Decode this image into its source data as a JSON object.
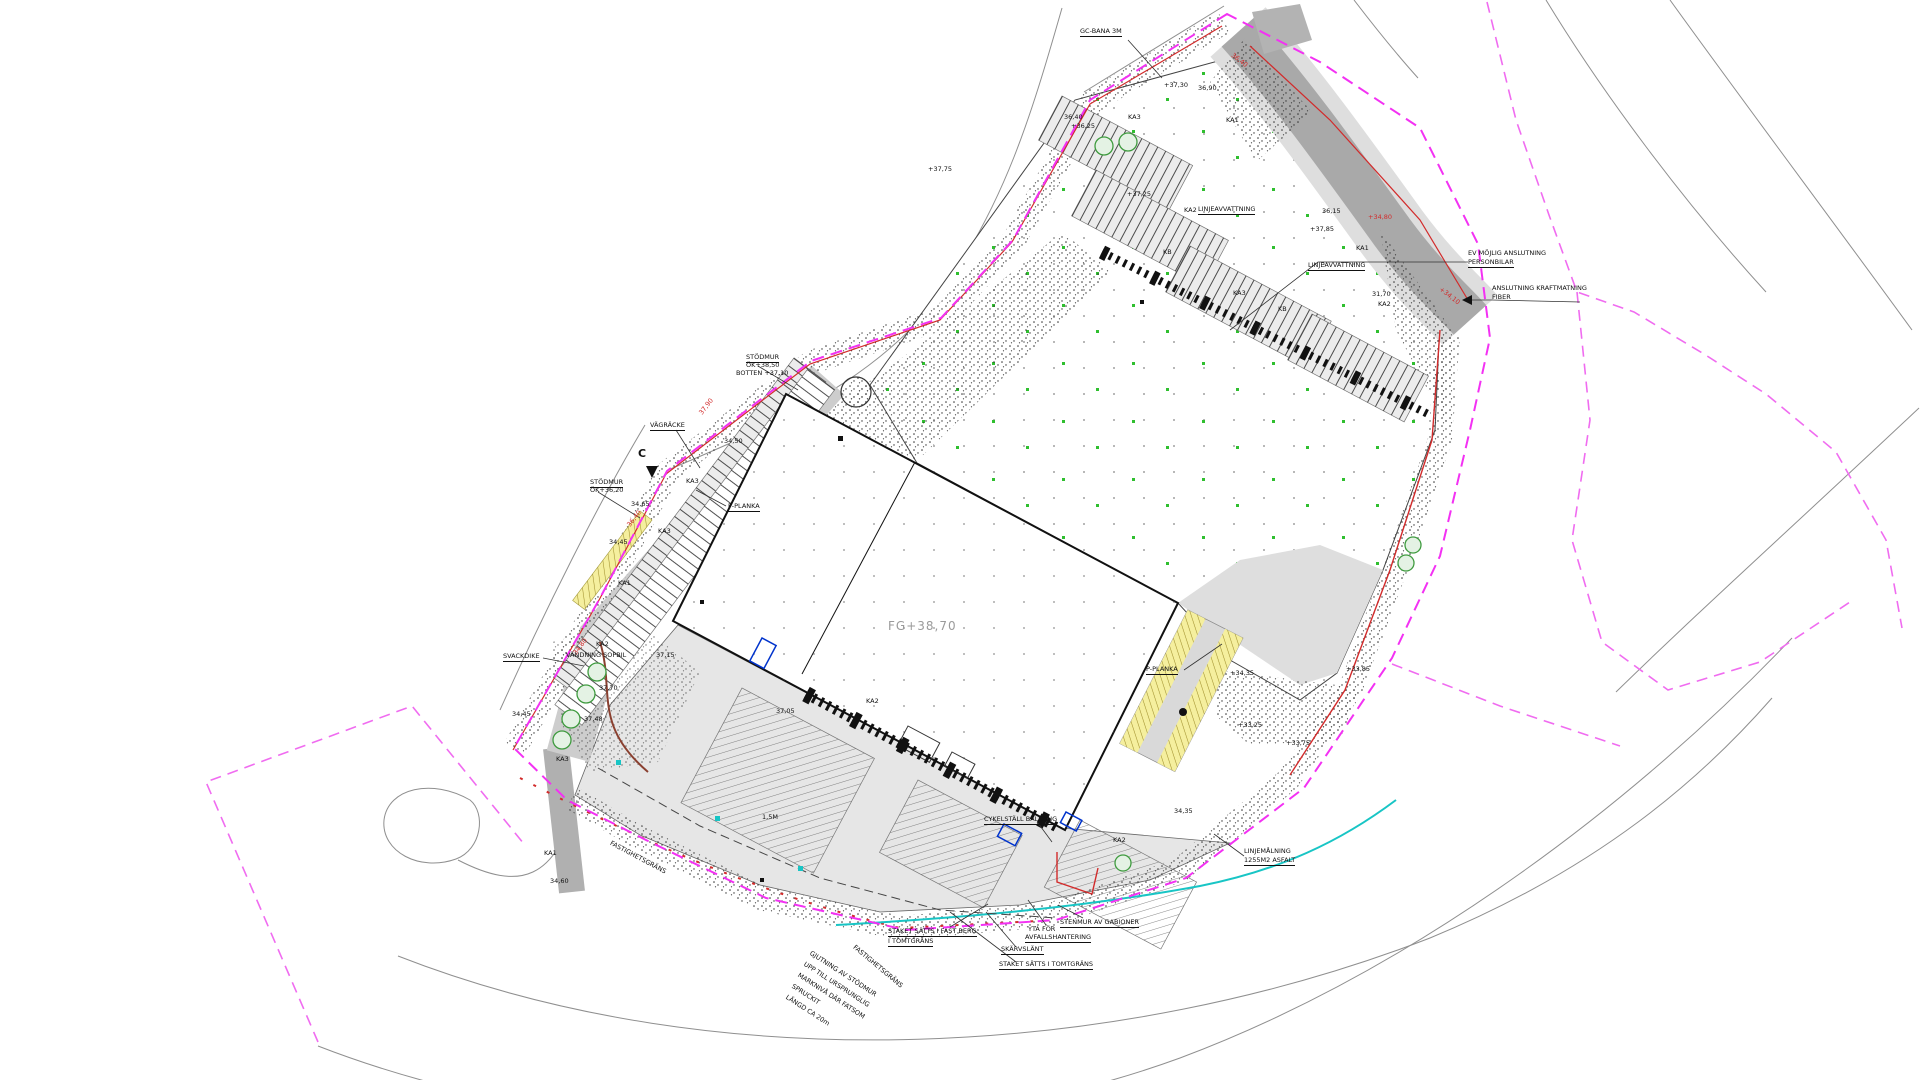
{
  "colors": {
    "property_boundary_magenta": "#f331f3",
    "outer_parcel_magenta": "#f06cf0",
    "curb_red": "#d22b2b",
    "water_line_cyan": "#18c5c5",
    "tree_green": "#3f9b3f",
    "speck_green": "#2fbf2f",
    "road_dark_gray": "#a9a9a9",
    "pavement_gray": "#e6e6e6",
    "marking_yellow": "#f5ef9e",
    "door_blue": "#0033cc",
    "slope_brown": "#8a4030"
  },
  "building": {
    "finished_floor_label": "FG+38,70"
  },
  "section_marker": {
    "letter": "C"
  },
  "labels": [
    {
      "t": "GC-BANA 3M",
      "x": 1080,
      "y": 28,
      "cls": "u",
      "n": "label-gc-bana"
    },
    {
      "t": "LINJEAVVATTNING",
      "x": 1198,
      "y": 206,
      "cls": "u",
      "n": "label-linjeavvattning-1"
    },
    {
      "t": "LINJEAVVATTNING",
      "x": 1308,
      "y": 262,
      "cls": "u",
      "n": "label-linjeavvattning-2"
    },
    {
      "t": "EV MÖJLIG ANSLUTNING",
      "x": 1468,
      "y": 250,
      "n": "label-ev-mojlig-anslutning"
    },
    {
      "t": "PERSONBILAR",
      "x": 1468,
      "y": 259,
      "cls": "u"
    },
    {
      "t": "ANSLUTNING KRAFTMATNING",
      "x": 1492,
      "y": 285,
      "n": "label-anslutning-kraftmatning"
    },
    {
      "t": "FIBER",
      "x": 1492,
      "y": 294
    },
    {
      "t": "STÖDMUR",
      "x": 746,
      "y": 354,
      "cls": "u",
      "n": "label-stodmur-1"
    },
    {
      "t": "ÖK+38,50",
      "x": 746,
      "y": 362
    },
    {
      "t": "BOTTEN +37,10",
      "x": 736,
      "y": 370
    },
    {
      "t": "VÄGRÄCKE",
      "x": 650,
      "y": 422,
      "cls": "u",
      "n": "label-vagracke"
    },
    {
      "t": "STÖDMUR",
      "x": 590,
      "y": 479,
      "cls": "u",
      "n": "label-stodmur-2"
    },
    {
      "t": "ÖK+36,20",
      "x": 590,
      "y": 487
    },
    {
      "t": "P-PLANKA",
      "x": 728,
      "y": 503,
      "cls": "u",
      "n": "label-p-planka-1"
    },
    {
      "t": "P-PLANKA",
      "x": 1146,
      "y": 666,
      "cls": "u",
      "n": "label-p-planka-2"
    },
    {
      "t": "SVACKDIKE",
      "x": 503,
      "y": 653,
      "cls": "u",
      "n": "label-svackdike"
    },
    {
      "t": "KA2",
      "x": 596,
      "y": 641
    },
    {
      "t": "VÄNDNING SOPBIL",
      "x": 566,
      "y": 652,
      "n": "label-vandning-sopbil"
    },
    {
      "t": "CYKELSTÄLL BALKONG",
      "x": 984,
      "y": 816,
      "cls": "u",
      "n": "label-cykelstall"
    },
    {
      "t": "STENMUR AV GABIONER",
      "x": 1060,
      "y": 919,
      "cls": "u",
      "n": "label-stenmur"
    },
    {
      "t": "YTA FÖR",
      "x": 1028,
      "y": 926
    },
    {
      "t": "AVFALLSHANTERING",
      "x": 1025,
      "y": 934,
      "cls": "u",
      "n": "label-avfallshantering"
    },
    {
      "t": "SKÄRVSLÄNT",
      "x": 1001,
      "y": 946,
      "cls": "u",
      "n": "label-skarvslant"
    },
    {
      "t": "STAKET SÄTTS I FAST BERG",
      "x": 888,
      "y": 928,
      "cls": "u",
      "n": "label-staket-fastberg"
    },
    {
      "t": "I TOMTGRÄNS",
      "x": 888,
      "y": 938,
      "cls": "u"
    },
    {
      "t": "STAKET SÄTTS I TOMTGRÄNS",
      "x": 999,
      "y": 961,
      "cls": "u",
      "n": "label-staket-tomtgrans"
    },
    {
      "t": "FASTIGHETSGRÄNS",
      "x": 856,
      "y": 944,
      "r": 40,
      "n": "label-fastighetsgrans-1"
    },
    {
      "t": "FASTIGHETSGRÄNS",
      "x": 612,
      "y": 840,
      "r": 28,
      "n": "label-fastighetsgrans-2"
    },
    {
      "t": "GJUTNING AV STÖDMUR",
      "x": 812,
      "y": 950,
      "r": 33,
      "n": "label-gjutning-note"
    },
    {
      "t": "UPP TILL URSPRUNGLIG",
      "x": 806,
      "y": 961,
      "r": 33
    },
    {
      "t": "MARKNIVÅ DÄR FATSOM",
      "x": 800,
      "y": 972,
      "r": 33
    },
    {
      "t": "SPRUCKIT",
      "x": 794,
      "y": 983,
      "r": 33
    },
    {
      "t": "LÄNGD CA 20m",
      "x": 788,
      "y": 994,
      "r": 33
    },
    {
      "t": "LINJEMÅLNING",
      "x": 1244,
      "y": 848,
      "n": "label-linjemalning"
    },
    {
      "t": "1255M2 ASFALT",
      "x": 1244,
      "y": 857,
      "cls": "u"
    },
    {
      "t": "1,5M",
      "x": 762,
      "y": 814
    },
    {
      "t": "KA3",
      "x": 1128,
      "y": 114
    },
    {
      "t": "KA1",
      "x": 1226,
      "y": 117
    },
    {
      "t": "KA2",
      "x": 1184,
      "y": 207
    },
    {
      "t": "KB",
      "x": 1163,
      "y": 249
    },
    {
      "t": "KA3",
      "x": 1233,
      "y": 290
    },
    {
      "t": "KB",
      "x": 1278,
      "y": 306
    },
    {
      "t": "KA1",
      "x": 1356,
      "y": 245
    },
    {
      "t": "KA2",
      "x": 1378,
      "y": 301
    },
    {
      "t": "KA3",
      "x": 686,
      "y": 478
    },
    {
      "t": "KA3",
      "x": 658,
      "y": 528
    },
    {
      "t": "KA1",
      "x": 618,
      "y": 580
    },
    {
      "t": "KA2",
      "x": 866,
      "y": 698
    },
    {
      "t": "KA2",
      "x": 1113,
      "y": 837
    },
    {
      "t": "KA1",
      "x": 544,
      "y": 850
    },
    {
      "t": "KA3",
      "x": 556,
      "y": 756
    },
    {
      "t": "+37,30",
      "x": 1164,
      "y": 82
    },
    {
      "t": "36,90",
      "x": 1198,
      "y": 85
    },
    {
      "t": "36,40",
      "x": 1064,
      "y": 114
    },
    {
      "t": "+36,25",
      "x": 1071,
      "y": 123
    },
    {
      "t": "+37,75",
      "x": 928,
      "y": 166
    },
    {
      "t": "+37,25",
      "x": 1127,
      "y": 191
    },
    {
      "t": "36,15",
      "x": 1322,
      "y": 208
    },
    {
      "t": "+37,85",
      "x": 1310,
      "y": 226
    },
    {
      "t": "31,70",
      "x": 1372,
      "y": 291
    },
    {
      "t": "34,50",
      "x": 724,
      "y": 438
    },
    {
      "t": "34,65",
      "x": 631,
      "y": 501
    },
    {
      "t": "34,45",
      "x": 609,
      "y": 539
    },
    {
      "t": "37,15",
      "x": 656,
      "y": 652
    },
    {
      "t": "37,70",
      "x": 599,
      "y": 685
    },
    {
      "t": "37,48",
      "x": 584,
      "y": 716
    },
    {
      "t": "34,45",
      "x": 512,
      "y": 711
    },
    {
      "t": "37,05",
      "x": 776,
      "y": 708
    },
    {
      "t": "34,35",
      "x": 1174,
      "y": 808
    },
    {
      "t": "+33,75",
      "x": 1286,
      "y": 740
    },
    {
      "t": "+34,35",
      "x": 1230,
      "y": 670
    },
    {
      "t": "+33,25",
      "x": 1238,
      "y": 722
    },
    {
      "t": "+33,85",
      "x": 1346,
      "y": 666
    },
    {
      "t": "34,60",
      "x": 550,
      "y": 878
    },
    {
      "t": "37,90",
      "x": 698,
      "y": 412,
      "r": -52,
      "cls": "red"
    },
    {
      "t": "36,40",
      "x": 626,
      "y": 524,
      "r": -52,
      "cls": "red"
    },
    {
      "t": "34,80",
      "x": 572,
      "y": 652,
      "r": -52,
      "cls": "red"
    },
    {
      "t": "36,40",
      "x": 1234,
      "y": 52,
      "r": 38,
      "cls": "red"
    },
    {
      "t": "+34,80",
      "x": 1368,
      "y": 214,
      "cls": "red"
    },
    {
      "t": "+34,10",
      "x": 1442,
      "y": 286,
      "r": 38,
      "cls": "red"
    }
  ]
}
